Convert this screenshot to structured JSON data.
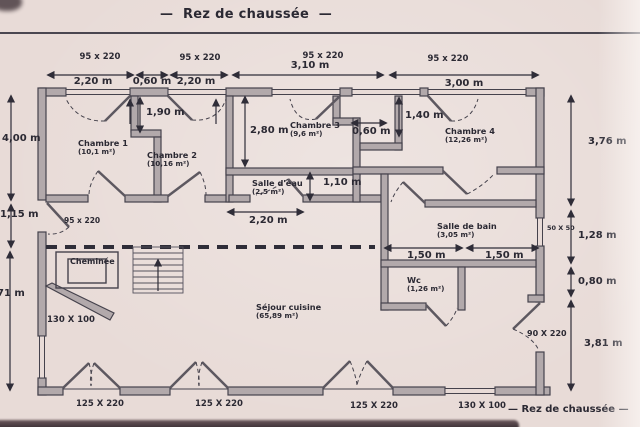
{
  "title": "Rez de chaussée",
  "footer": "Rez de chaussée",
  "dash": "—",
  "rooms": {
    "chambre1": {
      "name": "Chambre 1",
      "area": "(10,1 m²)"
    },
    "chambre2": {
      "name": "Chambre 2",
      "area": "(10,16 m²)"
    },
    "chambre3": {
      "name": "Chambre 3",
      "area": "(9,6 m²)"
    },
    "chambre4": {
      "name": "Chambre 4",
      "area": "(12,26 m²)"
    },
    "salle_eau": {
      "name": "Salle d'eau",
      "area": "(2,5 m²)"
    },
    "salle_bain": {
      "name": "Salle de bain",
      "area": "(3,05 m²)"
    },
    "wc": {
      "name": "Wc",
      "area": "(1,26 m²)"
    },
    "sejour": {
      "name": "Séjour cuisine",
      "area": "(65,89 m²)"
    },
    "cheminee": {
      "name": "Cheminée"
    }
  },
  "windows_top": {
    "w1": "95 x 220",
    "w2": "95 x 220",
    "w3": "95 x 220",
    "w4": "95 x 220"
  },
  "dims_top": {
    "d220a": "2,20 m",
    "d060": "0,60 m",
    "d220b": "2,20 m",
    "d310": "3,10 m",
    "d300": "3,00 m"
  },
  "dims_left": {
    "d400": "4,00 m",
    "d115": "1,15 m",
    "d271": "71 m"
  },
  "dims_right": {
    "d376": "3,76 m",
    "post": "50 X 50",
    "d128": "1,28 m",
    "d080": "0,80 m",
    "d381": "3,81 m"
  },
  "dims_inner": {
    "d190": "1,90 m",
    "d280": "2,80 m",
    "d060": "0,60 m",
    "d140": "1,40 m",
    "d110": "1,10 m",
    "d220": "2,20 m",
    "d150a": "1,50 m",
    "d150b": "1,50 m"
  },
  "openings": {
    "left_door": "95 x 220",
    "entry_door": "90 X 220",
    "left_window": "130 X 100",
    "bottom_window": "130 X 100",
    "french_door1": "125 X 220",
    "french_door2": "125 X 220",
    "french_door3": "125 X 220"
  },
  "colors": {
    "paper": "#e8dbd7",
    "wall": "#b2a9ab",
    "line": "#45424c",
    "text": "#2b2933"
  }
}
